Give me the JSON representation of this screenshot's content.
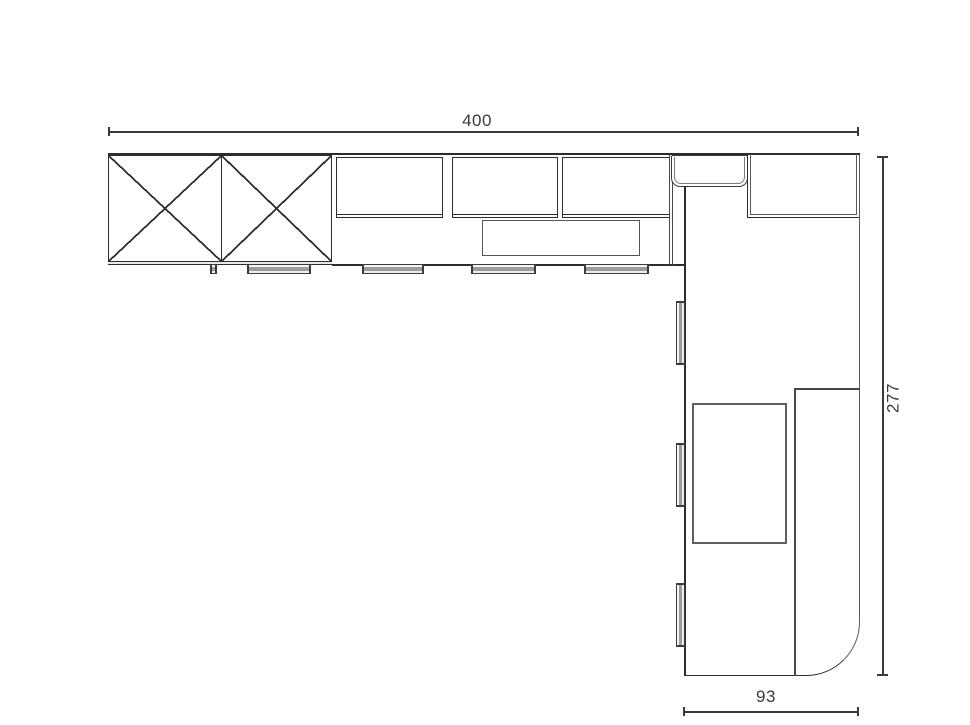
{
  "drawing": {
    "type": "kitchen floor plan, top view, L-shaped",
    "dim_top": "400",
    "dim_right": "277",
    "dim_bottom": "93",
    "colors": {
      "line_dark": "#2d2d2d",
      "line_light": "#5a5a5a",
      "dimension_text": "#3b3b3b",
      "handle_fill": "#9d9d9d",
      "background": "#ffffff"
    }
  }
}
